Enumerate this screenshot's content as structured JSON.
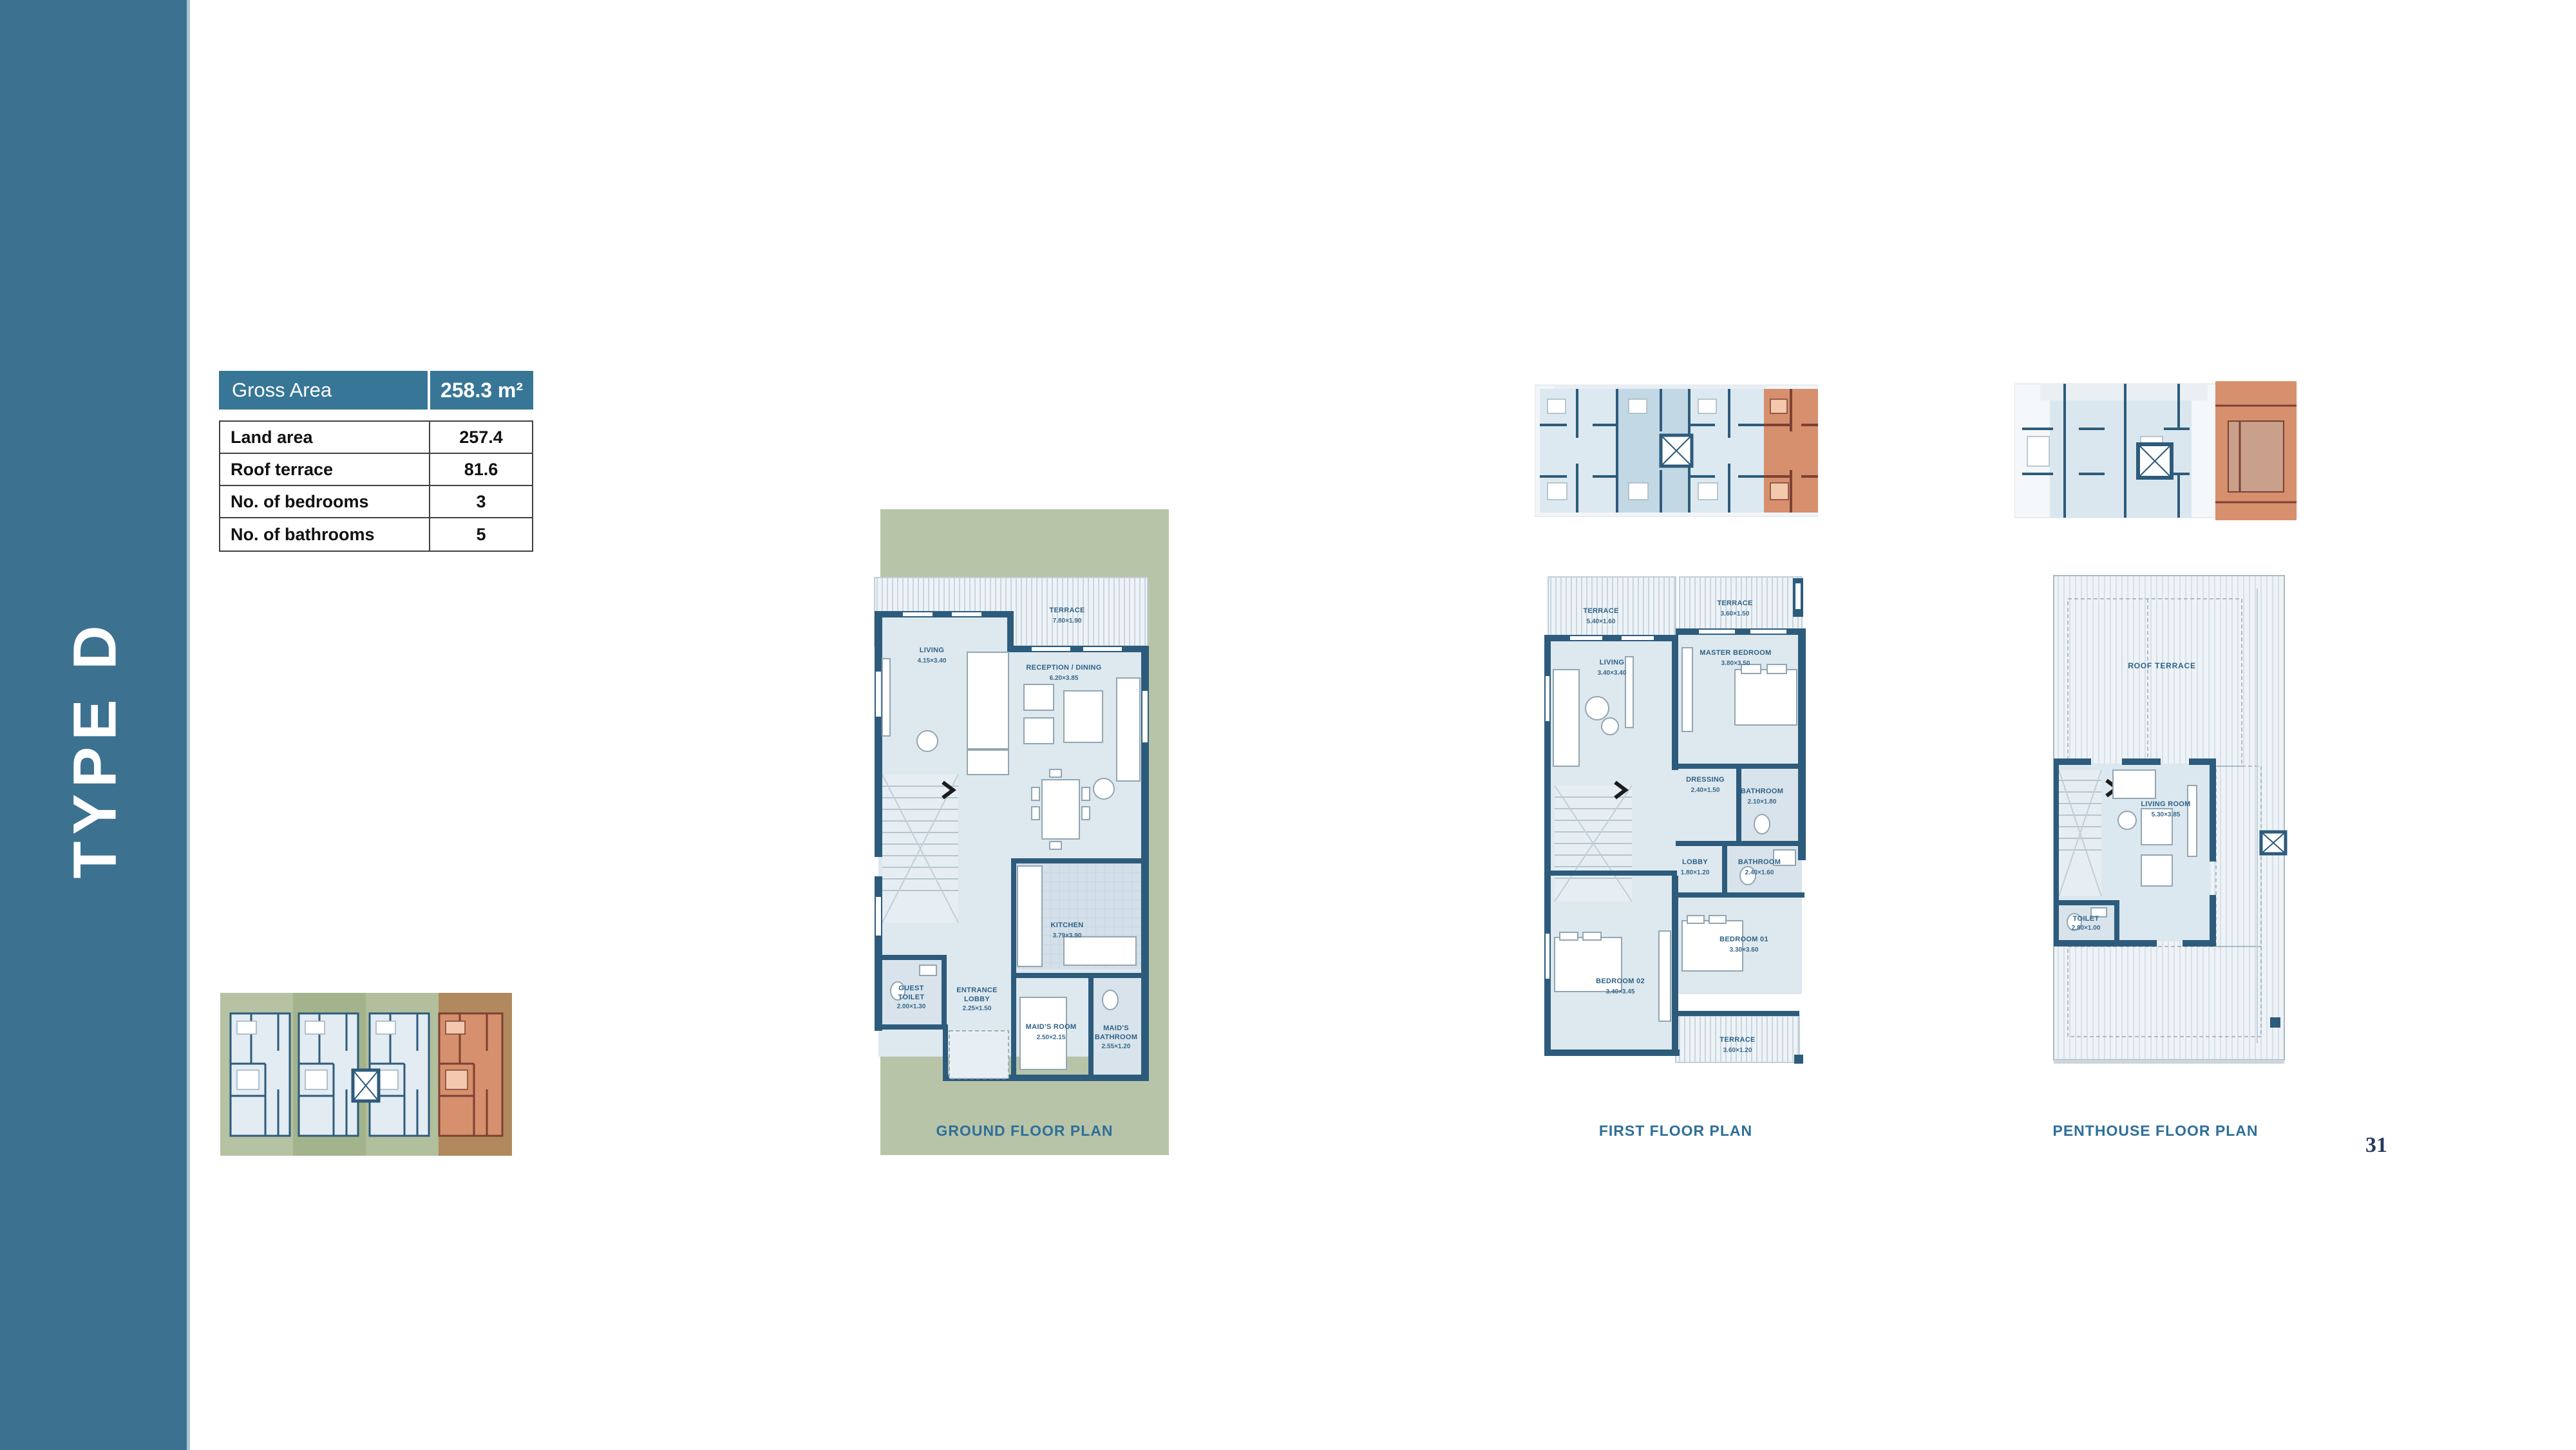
{
  "page": {
    "number": "31"
  },
  "sidebar": {
    "title": "TYPE D"
  },
  "summary_table": {
    "header": {
      "label": "Gross Area",
      "value": "258.3 m²"
    },
    "rows": [
      {
        "label": "Land area",
        "value": "257.4"
      },
      {
        "label": "Roof terrace",
        "value": "81.6"
      },
      {
        "label": "No. of bedrooms",
        "value": "3"
      },
      {
        "label": "No. of bathrooms",
        "value": "5"
      }
    ]
  },
  "plans": {
    "ground": {
      "caption": "GROUND FLOOR PLAN",
      "terrace": {
        "name": "TERRACE",
        "dim": "7.80×1.90"
      },
      "living": {
        "name": "LIVING",
        "dim": "4.15×3.40"
      },
      "reception": {
        "name": "RECEPTION / DINING",
        "dim": "6.20×3.85"
      },
      "kitchen": {
        "name": "KITCHEN",
        "dim": "3.79×3.90"
      },
      "guest_toilet": {
        "line1": "GUEST",
        "line2": "TOILET",
        "dim": "2.00×1.30"
      },
      "entrance_lobby": {
        "line1": "ENTRANCE",
        "line2": "LOBBY",
        "dim": "2.25×1.50"
      },
      "maids_room": {
        "name": "MAID'S ROOM",
        "dim": "2.50×2.15"
      },
      "maids_bathroom": {
        "line1": "MAID'S",
        "line2": "BATHROOM",
        "dim": "2.55×1.20"
      }
    },
    "first": {
      "caption": "FIRST FLOOR PLAN",
      "terrace_left": {
        "name": "TERRACE",
        "dim": "5.40×1.60"
      },
      "terrace_right": {
        "name": "TERRACE",
        "dim": "3.60×1.50"
      },
      "living": {
        "name": "LIVING",
        "dim": "3.40×3.40"
      },
      "master_bedroom": {
        "name": "MASTER BEDROOM",
        "dim": "3.80×3.50"
      },
      "dressing": {
        "name": "DRESSING",
        "dim": "2.40×1.50"
      },
      "bathroom_master": {
        "name": "BATHROOM",
        "dim": "2.10×1.80"
      },
      "lobby": {
        "name": "LOBBY",
        "dim": "1.80×1.20"
      },
      "bathroom_shared": {
        "name": "BATHROOM",
        "dim": "2.40×1.60"
      },
      "bedroom_01": {
        "name": "BEDROOM 01",
        "dim": "3.30×3.60"
      },
      "bedroom_02": {
        "name": "BEDROOM 02",
        "dim": "3.40×3.45"
      },
      "terrace_bottom": {
        "name": "TERRACE",
        "dim": "3.60×1.20"
      }
    },
    "penthouse": {
      "caption": "PENTHOUSE FLOOR PLAN",
      "roof_terrace": {
        "name": "ROOF TERRACE"
      },
      "living_room": {
        "name": "LIVING ROOM",
        "dim": "5.30×3.85"
      },
      "toilet": {
        "name": "TOILET",
        "dim": "2.80×1.00"
      }
    }
  },
  "colors": {
    "sidebar_teal": "#3d7190",
    "table_header_teal": "#377696",
    "plan_wall_blue": "#2d5b7c",
    "plan_floor_blue": "#dde8ef",
    "terrace_hatch": "#eef3f7",
    "green_panel": "#b8c4a8",
    "unit_highlight_orange": "#d7906d",
    "caption_blue": "#2e6f99"
  }
}
